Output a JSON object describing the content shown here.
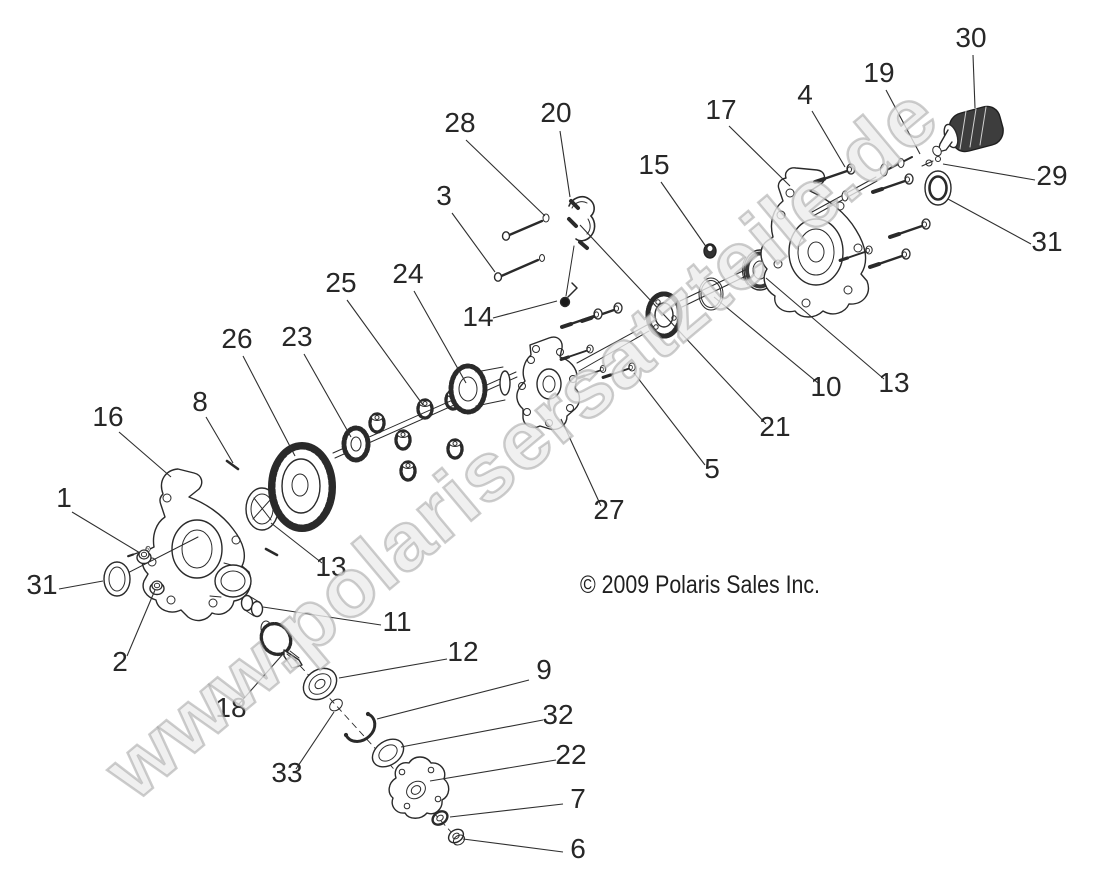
{
  "figure": {
    "background": "#ffffff",
    "ink_color": "#2a2a2a",
    "label_color": "#272727"
  },
  "watermark": {
    "text": "www.polarisersatzteile.de",
    "fill": "#ececec",
    "outline": "#9b9b9b"
  },
  "copyright": {
    "text": "© 2009 Polaris Sales Inc."
  },
  "callouts": [
    {
      "n": "1",
      "label": [
        64,
        507
      ],
      "line": [
        72,
        512,
        140,
        553
      ]
    },
    {
      "n": "2",
      "label": [
        120,
        671
      ],
      "line": [
        127,
        656,
        155,
        590
      ]
    },
    {
      "n": "3",
      "label": [
        444,
        205
      ],
      "line": [
        452,
        213,
        495,
        272
      ]
    },
    {
      "n": "4",
      "label": [
        805,
        104
      ],
      "line": [
        812,
        111,
        845,
        167
      ]
    },
    {
      "n": "5",
      "label": [
        712,
        478
      ],
      "line": [
        705,
        465,
        634,
        373
      ]
    },
    {
      "n": "6",
      "label": [
        578,
        858
      ],
      "line": [
        563,
        852,
        463,
        839
      ]
    },
    {
      "n": "7",
      "label": [
        578,
        808
      ],
      "line": [
        563,
        804,
        450,
        817
      ]
    },
    {
      "n": "8",
      "label": [
        200,
        411
      ],
      "line": [
        206,
        417,
        233,
        463
      ]
    },
    {
      "n": "9",
      "label": [
        544,
        679
      ],
      "line": [
        529,
        680,
        377,
        719
      ]
    },
    {
      "n": "10",
      "label": [
        826,
        396
      ],
      "line": [
        818,
        383,
        714,
        297
      ]
    },
    {
      "n": "11",
      "label": [
        397,
        631
      ],
      "line": [
        381,
        625,
        263,
        607
      ]
    },
    {
      "n": "12",
      "label": [
        463,
        661
      ],
      "line": [
        447,
        659,
        339,
        678
      ]
    },
    {
      "n": "13",
      "label": [
        331,
        576
      ],
      "line": [
        322,
        563,
        271,
        523
      ]
    },
    {
      "n": "13",
      "label": [
        894,
        392
      ],
      "line": [
        884,
        379,
        766,
        278
      ]
    },
    {
      "n": "14",
      "label": [
        478,
        326
      ],
      "line": [
        493,
        318,
        557,
        301
      ]
    },
    {
      "n": "15",
      "label": [
        654,
        174
      ],
      "line": [
        661,
        182,
        707,
        248
      ]
    },
    {
      "n": "16",
      "label": [
        108,
        426
      ],
      "line": [
        119,
        432,
        171,
        477
      ]
    },
    {
      "n": "17",
      "label": [
        721,
        119
      ],
      "line": [
        729,
        126,
        790,
        186
      ]
    },
    {
      "n": "18",
      "label": [
        231,
        717
      ],
      "line": [
        239,
        704,
        283,
        654
      ]
    },
    {
      "n": "19",
      "label": [
        879,
        82
      ],
      "line": [
        886,
        90,
        920,
        154
      ]
    },
    {
      "n": "20",
      "label": [
        556,
        122
      ],
      "line": [
        560,
        131,
        570,
        197
      ]
    },
    {
      "n": "21",
      "label": [
        775,
        436
      ],
      "line": [
        766,
        424,
        580,
        225
      ]
    },
    {
      "n": "22",
      "label": [
        571,
        764
      ],
      "line": [
        556,
        760,
        430,
        781
      ]
    },
    {
      "n": "23",
      "label": [
        297,
        346
      ],
      "line": [
        304,
        354,
        351,
        437
      ]
    },
    {
      "n": "24",
      "label": [
        408,
        283
      ],
      "line": [
        414,
        291,
        466,
        383
      ]
    },
    {
      "n": "25",
      "label": [
        341,
        292
      ],
      "line": [
        347,
        300,
        423,
        405
      ]
    },
    {
      "n": "26",
      "label": [
        237,
        348
      ],
      "line": [
        243,
        356,
        295,
        456
      ]
    },
    {
      "n": "27",
      "label": [
        609,
        519
      ],
      "line": [
        601,
        506,
        561,
        419
      ]
    },
    {
      "n": "28",
      "label": [
        460,
        132
      ],
      "line": [
        466,
        140,
        545,
        216
      ]
    },
    {
      "n": "29",
      "label": [
        1052,
        185
      ],
      "line": [
        1035,
        180,
        943,
        164
      ]
    },
    {
      "n": "30",
      "label": [
        971,
        47
      ],
      "line": [
        973,
        55,
        975,
        108
      ]
    },
    {
      "n": "31",
      "label": [
        42,
        594
      ],
      "line": [
        59,
        589,
        103,
        581
      ]
    },
    {
      "n": "31",
      "label": [
        1047,
        251
      ],
      "line": [
        1031,
        244,
        948,
        199
      ]
    },
    {
      "n": "32",
      "label": [
        558,
        724
      ],
      "line": [
        543,
        720,
        401,
        747
      ]
    },
    {
      "n": "33",
      "label": [
        287,
        782
      ],
      "line": [
        296,
        769,
        334,
        712
      ]
    }
  ]
}
